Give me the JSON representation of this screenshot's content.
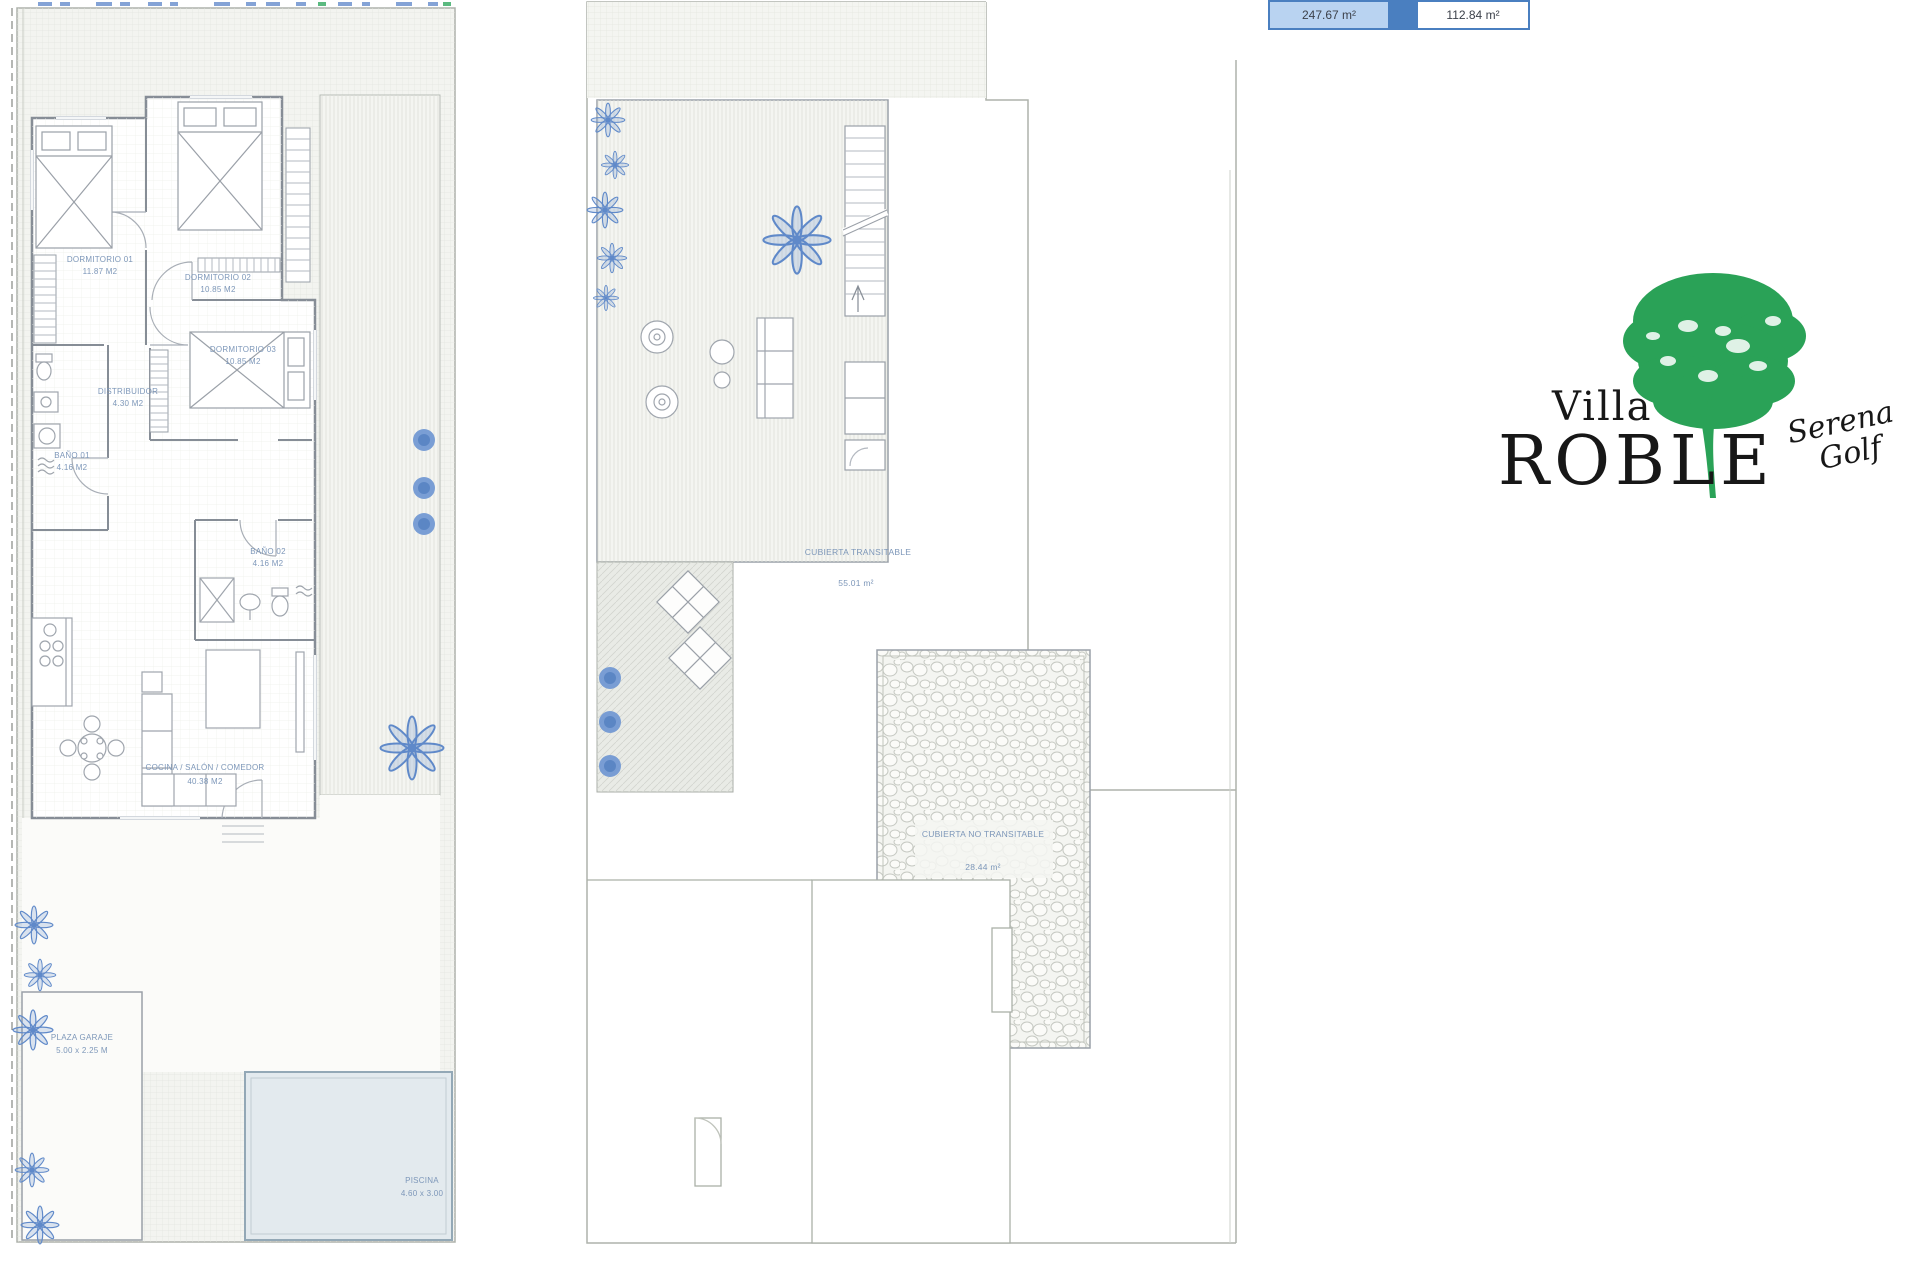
{
  "area_table": {
    "cells": [
      {
        "value": "247.67 m²"
      },
      {
        "value": "112.84 m²"
      }
    ]
  },
  "logo": {
    "villa": "Villa",
    "roble": "ROBLE",
    "script_top": "Serena",
    "script_bottom": "Golf"
  },
  "ground_floor": {
    "rooms": [
      {
        "name": "DORMITORIO 01",
        "area": "11.87 M2"
      },
      {
        "name": "DORMITORIO 02",
        "area": "10.85 M2"
      },
      {
        "name": "DORMITORIO 03",
        "area": "10.85 M2"
      },
      {
        "name": "DISTRIBUIDOR",
        "area": "4.30 M2"
      },
      {
        "name": "BAÑO 01",
        "area": "4.16 M2"
      },
      {
        "name": "BAÑO 02",
        "area": "4.16 M2"
      },
      {
        "name": "COCINA / SALÓN / COMEDOR",
        "area": "40.38 M2"
      }
    ],
    "garage": {
      "name": "PLAZA GARAJE",
      "size": "5.00 x 2.25 M"
    },
    "pool": {
      "name": "PISCINA",
      "size": "4.60 x 3.00"
    }
  },
  "roof": {
    "walkable": {
      "name": "CUBIERTA TRANSITABLE",
      "area": "55.01 m²"
    },
    "non_walkable": {
      "name": "CUBIERTA NO TRANSITABLE",
      "area": "28.44 m²"
    }
  },
  "colors": {
    "accent_blue": "#4a7fc0",
    "cell_blue": "#b9d3f1",
    "label_blue": "#7d97b9",
    "plant_blue": "#5f89c9",
    "logo_green": "#2aa257"
  }
}
